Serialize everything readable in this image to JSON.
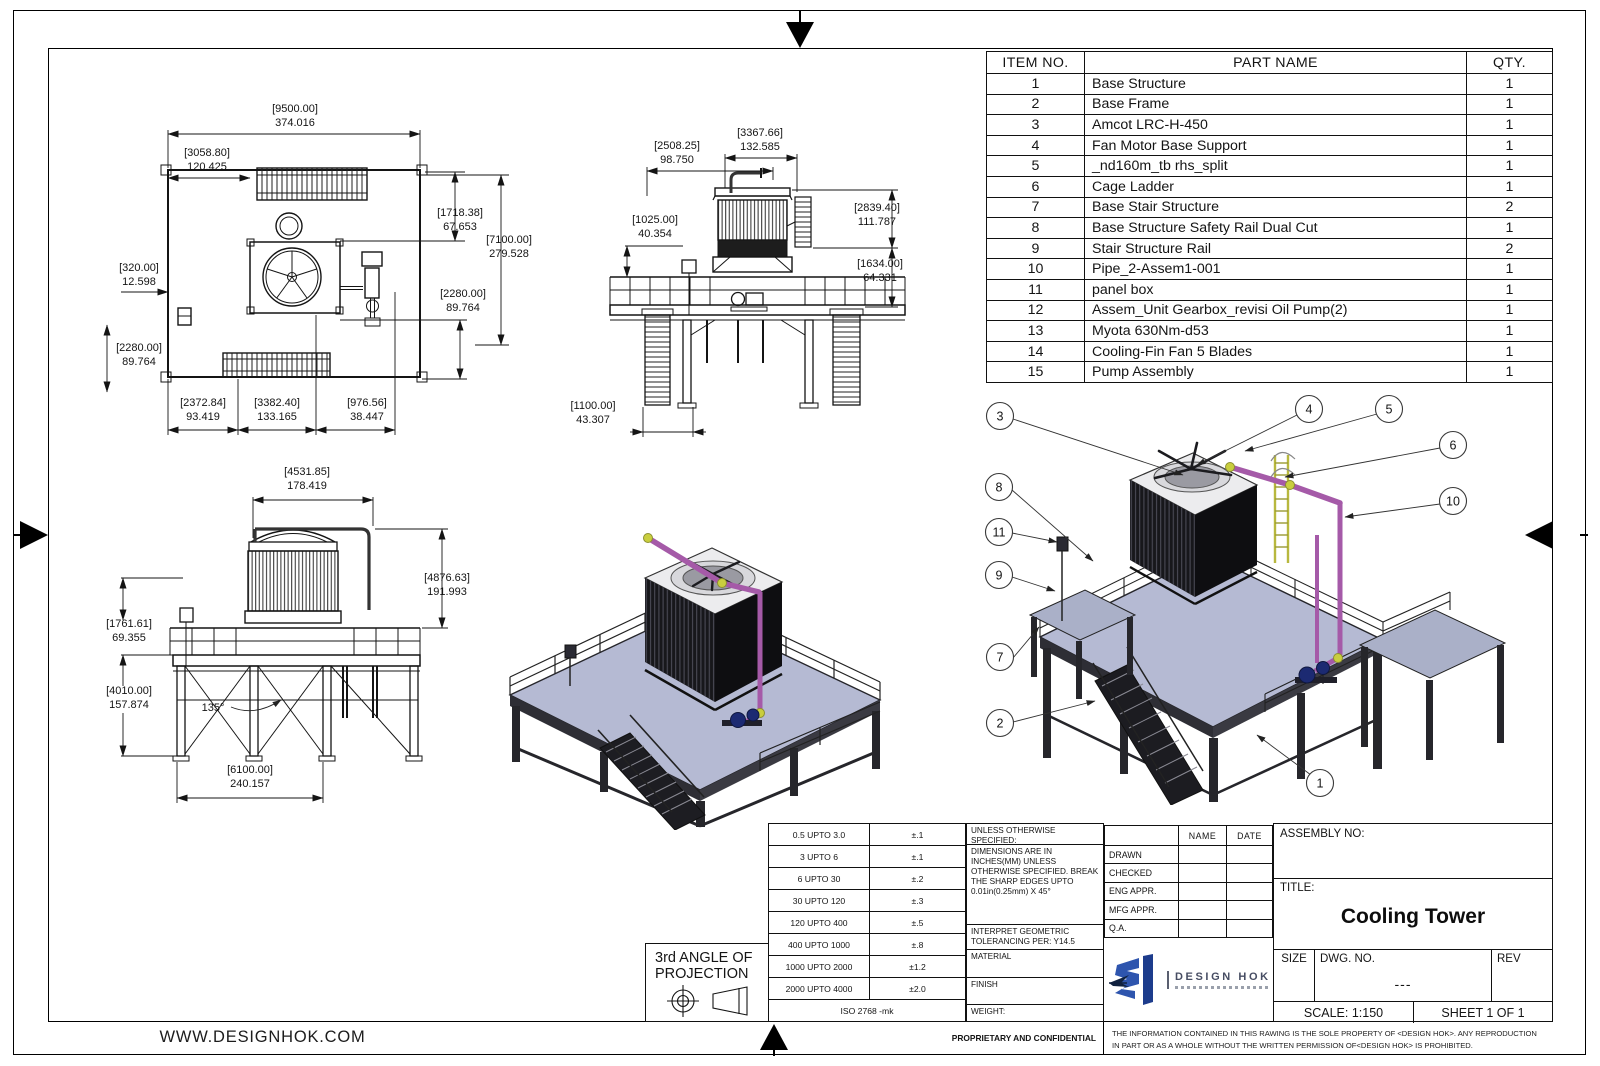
{
  "sheet": {
    "website": "WWW.DESIGNHOK.COM",
    "proprietary": "PROPRIETARY AND CONFIDENTIAL",
    "disclaimer_line1": "THE INFORMATION CONTAINED IN THIS RAWING IS THE SOLE PROPERTY OF <DESIGN HOK>.  ANY REPRODUCTION",
    "disclaimer_line2": "IN PART OR AS A WHOLE WITHOUT THE WRITTEN PERMISSION OF<DESIGN HOK> IS PROHIBITED."
  },
  "parts_table": {
    "headers": {
      "item": "ITEM NO.",
      "name": "PART NAME",
      "qty": "QTY."
    },
    "rows": [
      {
        "item": "1",
        "name": "Base Structure",
        "qty": "1"
      },
      {
        "item": "2",
        "name": "Base Frame",
        "qty": "1"
      },
      {
        "item": "3",
        "name": "Amcot LRC-H-450",
        "qty": "1"
      },
      {
        "item": "4",
        "name": "Fan Motor Base Support",
        "qty": "1"
      },
      {
        "item": "5",
        "name": "_nd160m_tb rhs_split",
        "qty": "1"
      },
      {
        "item": "6",
        "name": "Cage Ladder",
        "qty": "1"
      },
      {
        "item": "7",
        "name": "Base  Stair Structure",
        "qty": "2"
      },
      {
        "item": "8",
        "name": "Base Structure Safety Rail Dual Cut",
        "qty": "1"
      },
      {
        "item": "9",
        "name": "Stair Structure Rail",
        "qty": "2"
      },
      {
        "item": "10",
        "name": "Pipe_2-Assem1-001",
        "qty": "1"
      },
      {
        "item": "11",
        "name": "panel box",
        "qty": "1"
      },
      {
        "item": "12",
        "name": "Assem_Unit Gearbox_revisi Oil Pump(2)",
        "qty": "1"
      },
      {
        "item": "13",
        "name": "Myota 630Nm-d53",
        "qty": "1"
      },
      {
        "item": "14",
        "name": "Cooling-Fin Fan 5 Blades",
        "qty": "1"
      },
      {
        "item": "15",
        "name": "Pump Assembly",
        "qty": "1"
      }
    ]
  },
  "tolerance_table": {
    "rows": [
      {
        "range": "0.5 UPTO 3.0",
        "tol": "±.1"
      },
      {
        "range": "3 UPTO 6",
        "tol": "±.1"
      },
      {
        "range": "6 UPTO 30",
        "tol": "±.2"
      },
      {
        "range": "30 UPTO 120",
        "tol": "±.3"
      },
      {
        "range": "120 UPTO 400",
        "tol": "±.5"
      },
      {
        "range": "400 UPTO 1000",
        "tol": "±.8"
      },
      {
        "range": "1000 UPTO 2000",
        "tol": "±1.2"
      },
      {
        "range": "2000 UPTO 4000",
        "tol": "±2.0"
      }
    ],
    "standard": "ISO 2768 -mk"
  },
  "notes": {
    "unless": "UNLESS OTHERWISE SPECIFIED:",
    "dims_note": "DIMENSIONS ARE IN INCHES(MM) UNLESS OTHERWISE SPECIFIED. BREAK THE SHARP EDGES UPTO 0.01in(0.25mm) X 45°",
    "interpret": "INTERPRET GEOMETRIC TOLERANCING PER: Y14.5",
    "material": "MATERIAL",
    "finish": "FINISH",
    "weight": "WEIGHT:"
  },
  "approval": {
    "name_header": "NAME",
    "date_header": "DATE",
    "rows": [
      "DRAWN",
      "CHECKED",
      "ENG APPR.",
      "MFG APPR.",
      "Q.A."
    ]
  },
  "title_block": {
    "assembly_no_label": "ASSEMBLY NO:",
    "title_label": "TITLE:",
    "title": "Cooling Tower",
    "size_label": "SIZE",
    "dwg_label": "DWG.  NO.",
    "dwg_no": "---",
    "rev_label": "REV",
    "scale": "SCALE: 1:150",
    "sheet": "SHEET 1 OF 1"
  },
  "projection": {
    "line1": "3rd ANGLE OF",
    "line2": "PROJECTION"
  },
  "logo": {
    "text": "DESIGN HOK"
  },
  "views": {
    "plan": {
      "dims": [
        {
          "mm": "[9500.00]",
          "in": "374.016"
        },
        {
          "mm": "[3058.80]",
          "in": "120.425"
        },
        {
          "mm": "[1718.38]",
          "in": "67.653"
        },
        {
          "mm": "[7100.00]",
          "in": "279.528"
        },
        {
          "mm": "[2280.00]",
          "in": "89.764"
        },
        {
          "mm": "[320.00]",
          "in": "12.598"
        },
        {
          "mm": "[2280.00]",
          "in": "89.764"
        },
        {
          "mm": "[2372.84]",
          "in": "93.419"
        },
        {
          "mm": "[3382.40]",
          "in": "133.165"
        },
        {
          "mm": "[976.56]",
          "in": "38.447"
        }
      ]
    },
    "front": {
      "dims": [
        {
          "mm": "[3367.66]",
          "in": "132.585"
        },
        {
          "mm": "[2508.25]",
          "in": "98.750"
        },
        {
          "mm": "[1025.00]",
          "in": "40.354"
        },
        {
          "mm": "[2839.40]",
          "in": "111.787"
        },
        {
          "mm": "[1634.00]",
          "in": "64.331"
        },
        {
          "mm": "[1100.00]",
          "in": "43.307"
        }
      ]
    },
    "side": {
      "dims": [
        {
          "mm": "[4531.85]",
          "in": "178.419"
        },
        {
          "mm": "[4876.63]",
          "in": "191.993"
        },
        {
          "mm": "[1761.61]",
          "in": "69.355"
        },
        {
          "mm": "[4010.00]",
          "in": "157.874"
        },
        {
          "mm": "[6100.00]",
          "in": "240.157"
        }
      ],
      "angle": "135°"
    }
  },
  "balloons": [
    "3",
    "4",
    "5",
    "6",
    "10",
    "8",
    "11",
    "9",
    "7",
    "2",
    "1"
  ],
  "colors": {
    "pipe_purple": "#a55aa8",
    "elbow_yellow": "#c9ce3e",
    "deck_blue": "#b5bad3",
    "pump_blue": "#1c2a72",
    "logo_blue": "#2e55ae",
    "line_black": "#141414"
  }
}
